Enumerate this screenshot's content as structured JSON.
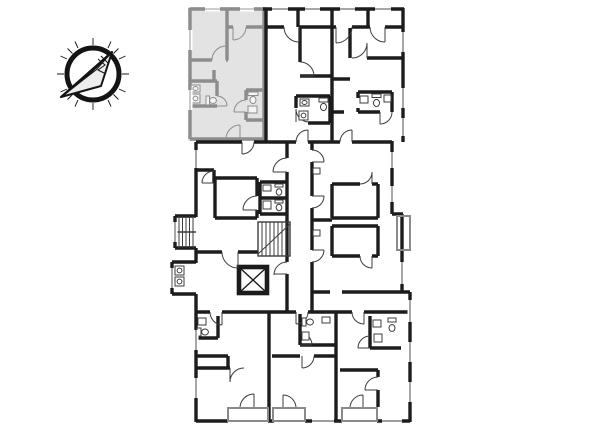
{
  "view": {
    "type": "architectural-floor-plan",
    "background": "#ffffff",
    "description": "building floor plan with one highlighted apartment unit (top-left) and a north-arrow compass"
  },
  "colors": {
    "wall": "#1c1c1c",
    "detail": "#3c3c3c",
    "unit_wall": "#8d8d8d",
    "unit_fill": "#e3e3e3",
    "balcony": "#8a8a8a",
    "compass": "#141414",
    "compass_fill": "#ededed"
  },
  "compass": {
    "icon": "north-arrow-compass-icon",
    "style": "sketched paper-plane arrow in circle with radial ticks, pointing lower-left"
  },
  "floorplan": {
    "highlighted_unit": {
      "state": "selected",
      "location": "top-left",
      "fill": "#e3e3e3",
      "wall_color": "#8d8d8d"
    },
    "features": [
      {
        "name": "staircase",
        "count": 2
      },
      {
        "name": "elevator-shaft-x",
        "count": 1
      },
      {
        "name": "balcony",
        "count": 4
      },
      {
        "name": "bathroom-fixtures",
        "count": 10
      },
      {
        "name": "door-swing-arc",
        "count": 26
      }
    ]
  }
}
